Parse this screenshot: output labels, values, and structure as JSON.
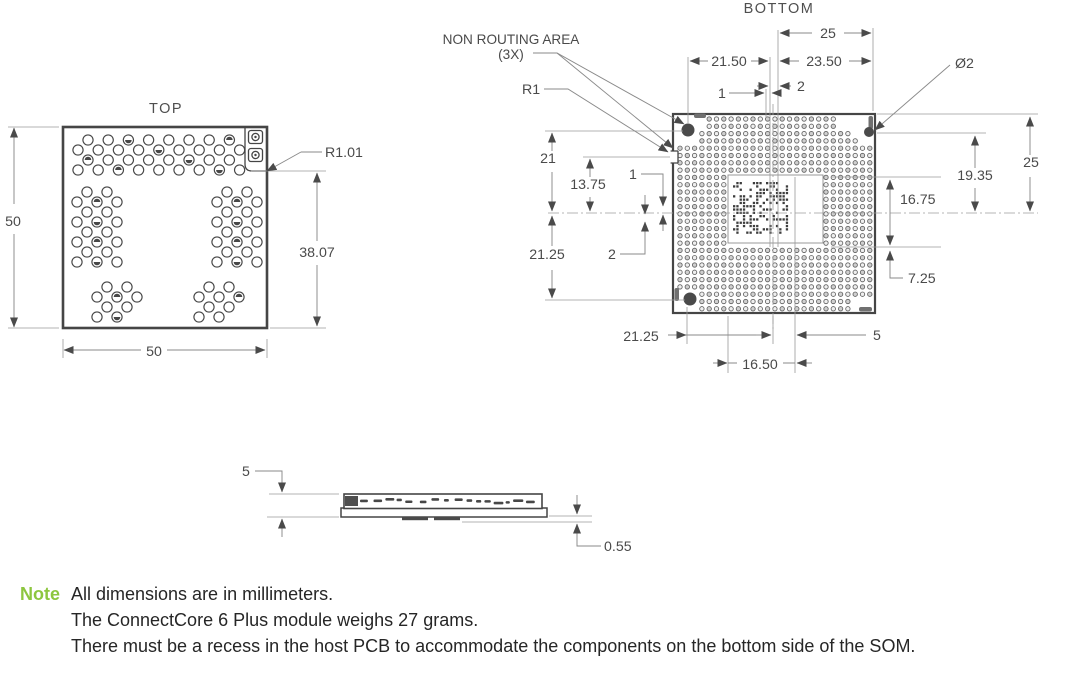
{
  "drawing": {
    "top_view": {
      "title": "TOP",
      "dim_height": "50",
      "dim_width": "50",
      "dim_corner_fillet": "R1.01",
      "dim_step_height": "38.07"
    },
    "bottom_view": {
      "title": "BOTTOM",
      "callout_non_routing_area": "NON ROUTING AREA",
      "callout_non_routing_qty": "(3X)",
      "callout_edge_fillet": "R1",
      "callout_hole_diameter": "Ø2",
      "dim_top_25": "25",
      "dim_top_21_50": "21.50",
      "dim_top_23_50": "23.50",
      "dim_top_gap_2": "2",
      "dim_top_gap_1": "1",
      "dim_left_21": "21",
      "dim_left_13_75": "13.75",
      "dim_left_gap_1": "1",
      "dim_left_gap_2": "2",
      "dim_left_21_25": "21.25",
      "dim_right_25": "25",
      "dim_right_19_35": "19.35",
      "dim_right_16_75": "16.75",
      "dim_right_7_25": "7.25",
      "dim_bottom_21_25": "21.25",
      "dim_bottom_16_50": "16.50",
      "dim_bottom_5": "5"
    },
    "side_view": {
      "dim_thickness_5": "5",
      "dim_standoff_0_55": "0.55"
    }
  },
  "note": {
    "label": "Note",
    "label_color": "#8dc63f",
    "lines": [
      "All dimensions are in millimeters.",
      "The ConnectCore 6 Plus module weighs 27 grams.",
      "There must be a recess in the host PCB to accommodate the components on the bottom side of the SOM."
    ]
  }
}
